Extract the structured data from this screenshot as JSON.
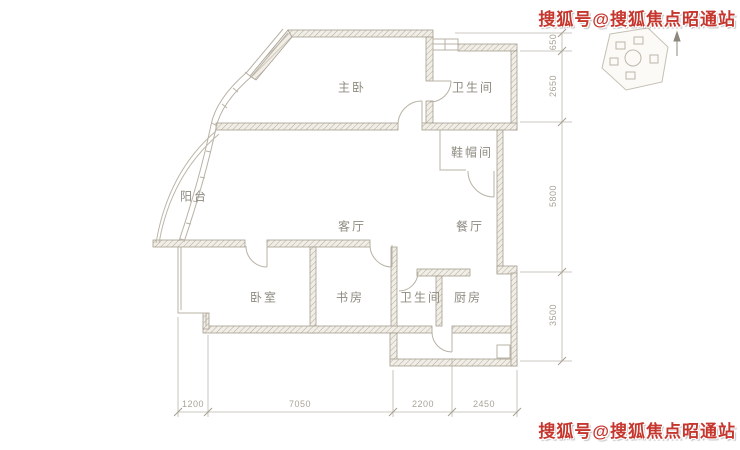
{
  "watermarks": {
    "top": "搜狐号@搜狐焦点昭通站",
    "bottom": "搜狐号@搜狐焦点昭通站",
    "color": "#c5372e"
  },
  "floorplan": {
    "rooms": [
      {
        "id": "master-bedroom",
        "label": "主卧"
      },
      {
        "id": "bathroom-top",
        "label": "卫生间"
      },
      {
        "id": "cloakroom",
        "label": "鞋帽间"
      },
      {
        "id": "balcony",
        "label": "阳台"
      },
      {
        "id": "living-room",
        "label": "客厅"
      },
      {
        "id": "dining-room",
        "label": "餐厅"
      },
      {
        "id": "bedroom",
        "label": "卧室"
      },
      {
        "id": "study",
        "label": "书房"
      },
      {
        "id": "bathroom-bottom",
        "label": "卫生间"
      },
      {
        "id": "kitchen",
        "label": "厨房"
      }
    ],
    "dims_right": [
      {
        "label": "650"
      },
      {
        "label": "2650"
      },
      {
        "label": "5800"
      },
      {
        "label": "3500"
      }
    ],
    "dims_bottom": [
      {
        "label": "1200"
      },
      {
        "label": "7050"
      },
      {
        "label": "2200"
      },
      {
        "label": "2450"
      }
    ],
    "colors": {
      "wall_hatch": "#b3aa9c",
      "thin_line": "#b9b2a5",
      "room_text": "#8e8b80",
      "dim_text": "#a9a398"
    }
  }
}
